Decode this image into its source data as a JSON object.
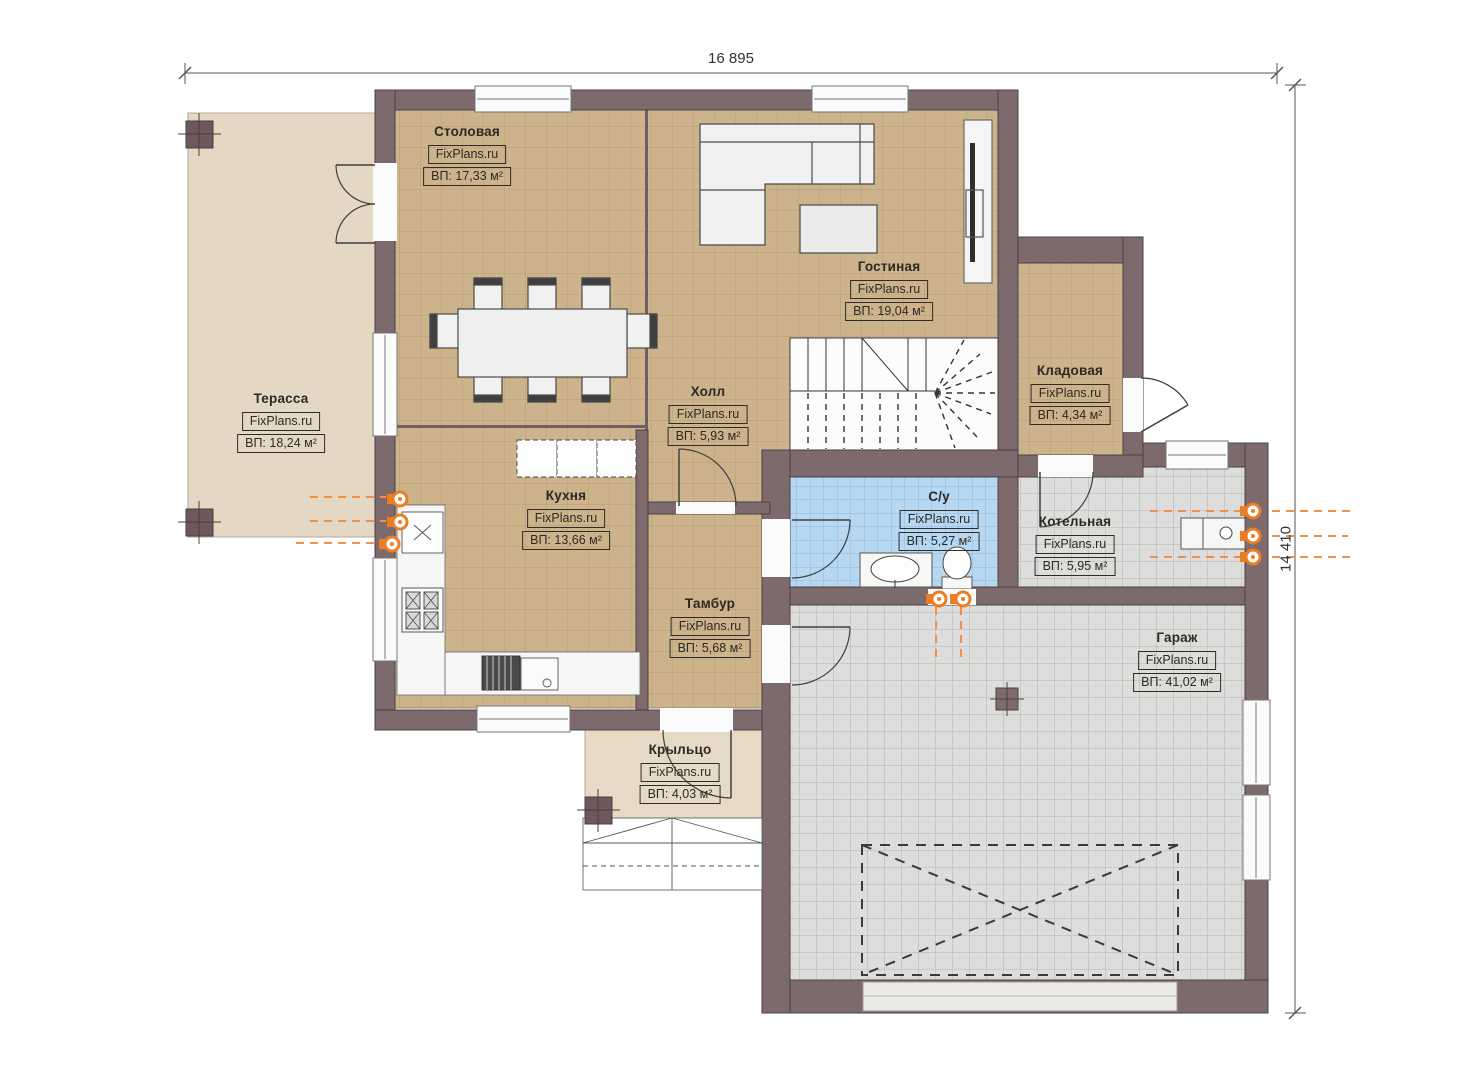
{
  "title": "План первого этажа",
  "watermark": "FixPlans.ru",
  "dimensions": {
    "width": "16 895",
    "height": "14 410"
  },
  "rooms": {
    "dining": {
      "name": "Столовая",
      "area": "ВП: 17,33 м²"
    },
    "living": {
      "name": "Гостиная",
      "area": "ВП: 19,04 м²"
    },
    "terrace": {
      "name": "Терасса",
      "area": "ВП: 18,24 м²"
    },
    "hall": {
      "name": "Холл",
      "area": "ВП: 5,93 м²"
    },
    "kitchen": {
      "name": "Кухня",
      "area": "ВП: 13,66 м²"
    },
    "storage": {
      "name": "Кладовая",
      "area": "ВП: 4,34 м²"
    },
    "bathroom": {
      "name": "С/у",
      "area": "ВП: 5,27 м²"
    },
    "boiler": {
      "name": "Котельная",
      "area": "ВП: 5,95 м²"
    },
    "vestibule": {
      "name": "Тамбур",
      "area": "ВП: 5,68 м²"
    },
    "garage": {
      "name": "Гараж",
      "area": "ВП: 41,02 м²"
    },
    "porch": {
      "name": "Крыльцо",
      "area": "ВП: 4,03 м²"
    }
  },
  "colors": {
    "wall": "#7d6a6d",
    "wall_outline": "#4c4144",
    "floor_wood": "#ccb38b",
    "floor_terrace": "#e4d8c4",
    "floor_gray": "#dddddb",
    "floor_blue": "#b7d8f0",
    "utility_orange": "#ed7d21"
  }
}
